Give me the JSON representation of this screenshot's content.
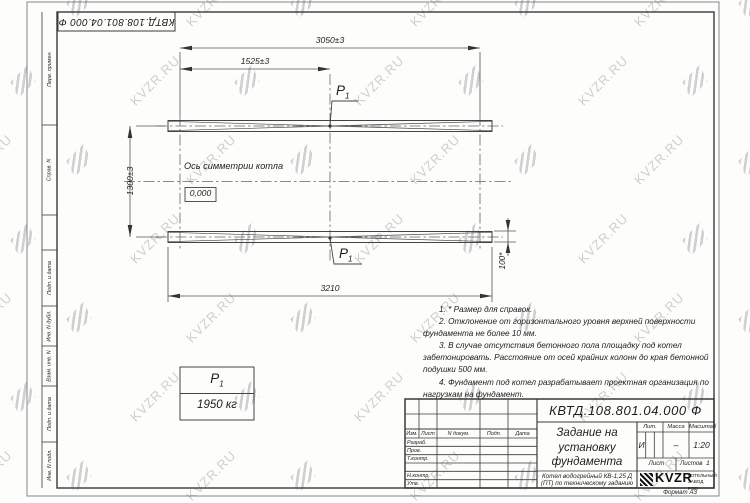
{
  "sheet": {
    "doc_number": "КВТД.108.801.04.000 Ф",
    "format_label": "Формат А3",
    "watermark_text": "KVZR.RU",
    "margin_labels": [
      "Перв. примен.",
      "Справ. N",
      "Подп. и дата",
      "Инв. N дубл.",
      "Взам. инв. N",
      "Подп. и дата",
      "Инв. N подл."
    ]
  },
  "drawing": {
    "dims": {
      "overall": "3050±3",
      "half": "1525±3",
      "vertical": "1300±3",
      "bottom": "3210",
      "width_ref": "100*"
    },
    "axis_label": "Ось симметрии котла",
    "level_mark": "0,000",
    "p_symbol": "P",
    "p_sub": "1",
    "load_value": "1950 кг",
    "notes": [
      "1. * Размер для справок.",
      "2. Отклонение от горизонтального уровня верхней поверхности фундамента не более 10 мм.",
      "3. В случае отсутствия бетонного пола площадку под котел забетонировать. Расстояние от осей крайних колонн до края бетонной подушки 500 мм.",
      "4. Фундамент под котел разрабатывает проектная организация по нагрузкам на фундамент."
    ]
  },
  "titleblock": {
    "title": "Задание на установку фундамента",
    "subtitle": "Котел водогрейный КВ-1,25 Д (ПТ) по техническому заданию",
    "col_headers": [
      "Изм.",
      "Лист",
      "N докум.",
      "Подп.",
      "Дата"
    ],
    "row_labels": [
      "Разраб.",
      "Пров.",
      "Т.контр.",
      "Н.контр.",
      "Утв."
    ],
    "lit_label": "Лит.",
    "mass_label": "Масса",
    "scale_label": "Масштаб",
    "lit_value": "И",
    "mass_value": "–",
    "scale_value": "1:20",
    "sheet_label": "Лист",
    "sheets_label": "Листов",
    "sheets_value": "1",
    "logo_text": "KVZR",
    "company_line1": "КОТЕЛЬНЫЙ",
    "company_line2": "ЗАВОД РЭП"
  }
}
